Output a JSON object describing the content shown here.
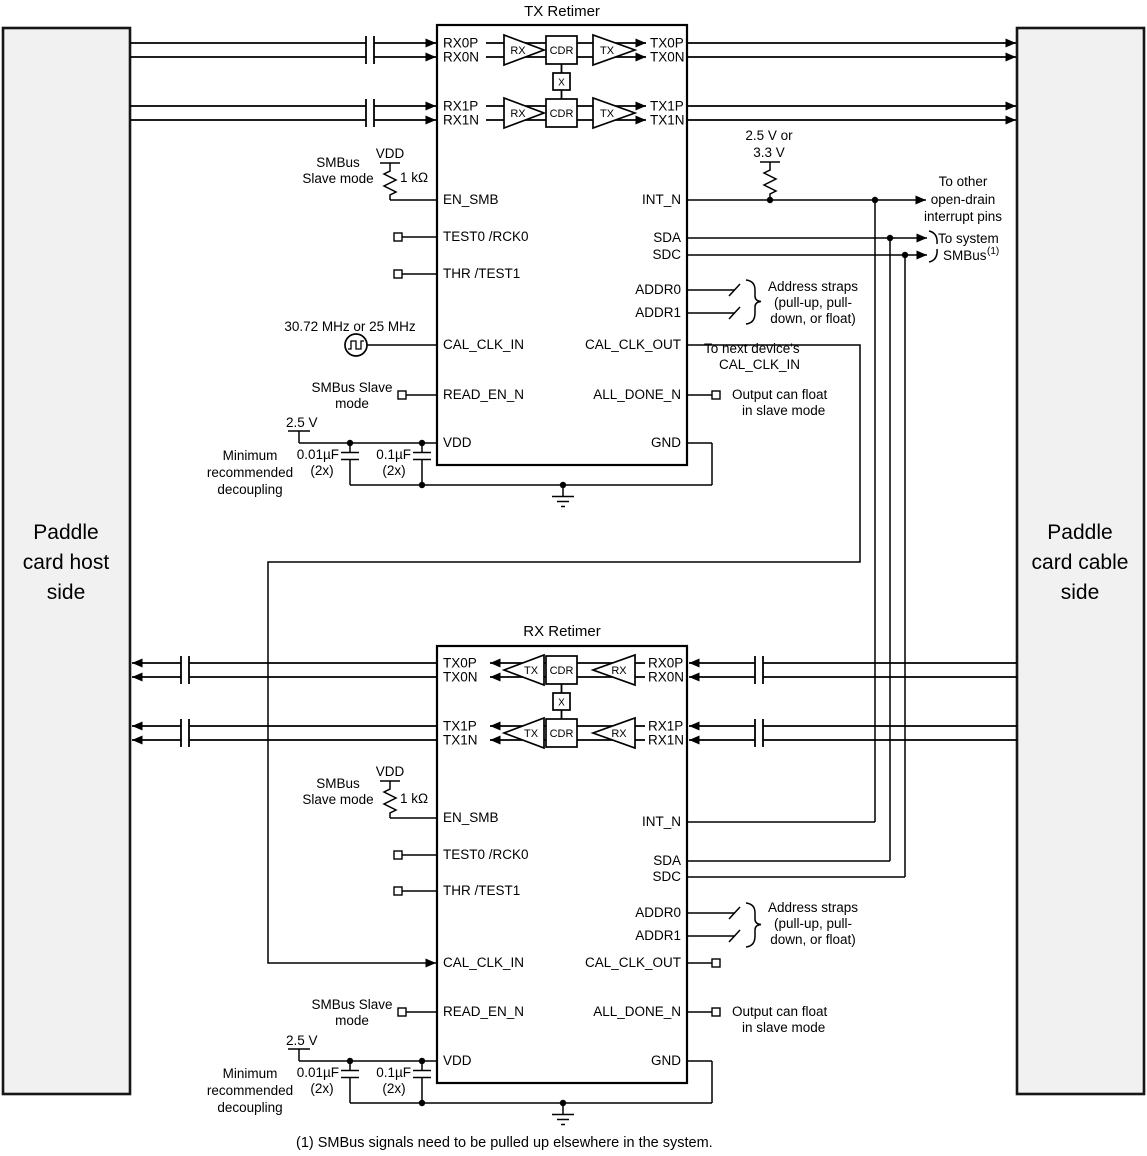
{
  "colors": {
    "background": "#ffffff",
    "panel_fill": "#f1f1f1",
    "line": "#000000"
  },
  "paddles": {
    "left": [
      "Paddle",
      "card host",
      "side"
    ],
    "right": [
      "Paddle",
      "card cable",
      "side"
    ]
  },
  "retimers": {
    "tx_title": "TX Retimer",
    "rx_title": "RX Retimer"
  },
  "pins": {
    "rx0p": "RX0P",
    "rx0n": "RX0N",
    "rx1p": "RX1P",
    "rx1n": "RX1N",
    "tx0p": "TX0P",
    "tx0n": "TX0N",
    "tx1p": "TX1P",
    "tx1n": "TX1N",
    "en_smb": "EN_SMB",
    "test0": "TEST0 /RCK0",
    "thr": "THR /TEST1",
    "cal_clk_in": "CAL_CLK_IN",
    "read_en_n": "READ_EN_N",
    "vdd": "VDD",
    "int_n": "INT_N",
    "sda": "SDA",
    "sdc": "SDC",
    "addr0": "ADDR0",
    "addr1": "ADDR1",
    "cal_clk_out": "CAL_CLK_OUT",
    "all_done_n": "ALL_DONE_N",
    "gnd": "GND"
  },
  "blocks": {
    "rx_amp": "RX",
    "tx_amp": "TX",
    "cdr": "CDR",
    "crosspoint": "X"
  },
  "ann": {
    "vdd_supply": "VDD",
    "smbus": "SMBus",
    "slave_mode": "Slave mode",
    "r1k": "1 kΩ",
    "clk_freq": "30.72 MHz or 25 MHz",
    "smbus_slave": "SMBus Slave",
    "mode": "mode",
    "v25": "2.5 V",
    "c1": "0.01µF",
    "c2": "0.1µF",
    "qty": "(2x)",
    "dec1": "Minimum",
    "dec2": "recommended",
    "dec3": "decoupling",
    "pu1": "2.5 V or",
    "pu2": "3.3 V",
    "int1": "To other",
    "int2": "open-drain",
    "int3": "interrupt pins",
    "sys1": "To system",
    "sys2": "SMBus",
    "sys_sup": "(1)",
    "addr1": "Address straps",
    "addr2": "(pull-up, pull-",
    "addr3": "down, or float)",
    "next1": "To next device's",
    "next2": "CAL_CLK_IN",
    "float1": "Output can float",
    "float2": "in slave mode"
  },
  "footnote": "(1) SMBus signals need to be pulled up elsewhere in the system."
}
